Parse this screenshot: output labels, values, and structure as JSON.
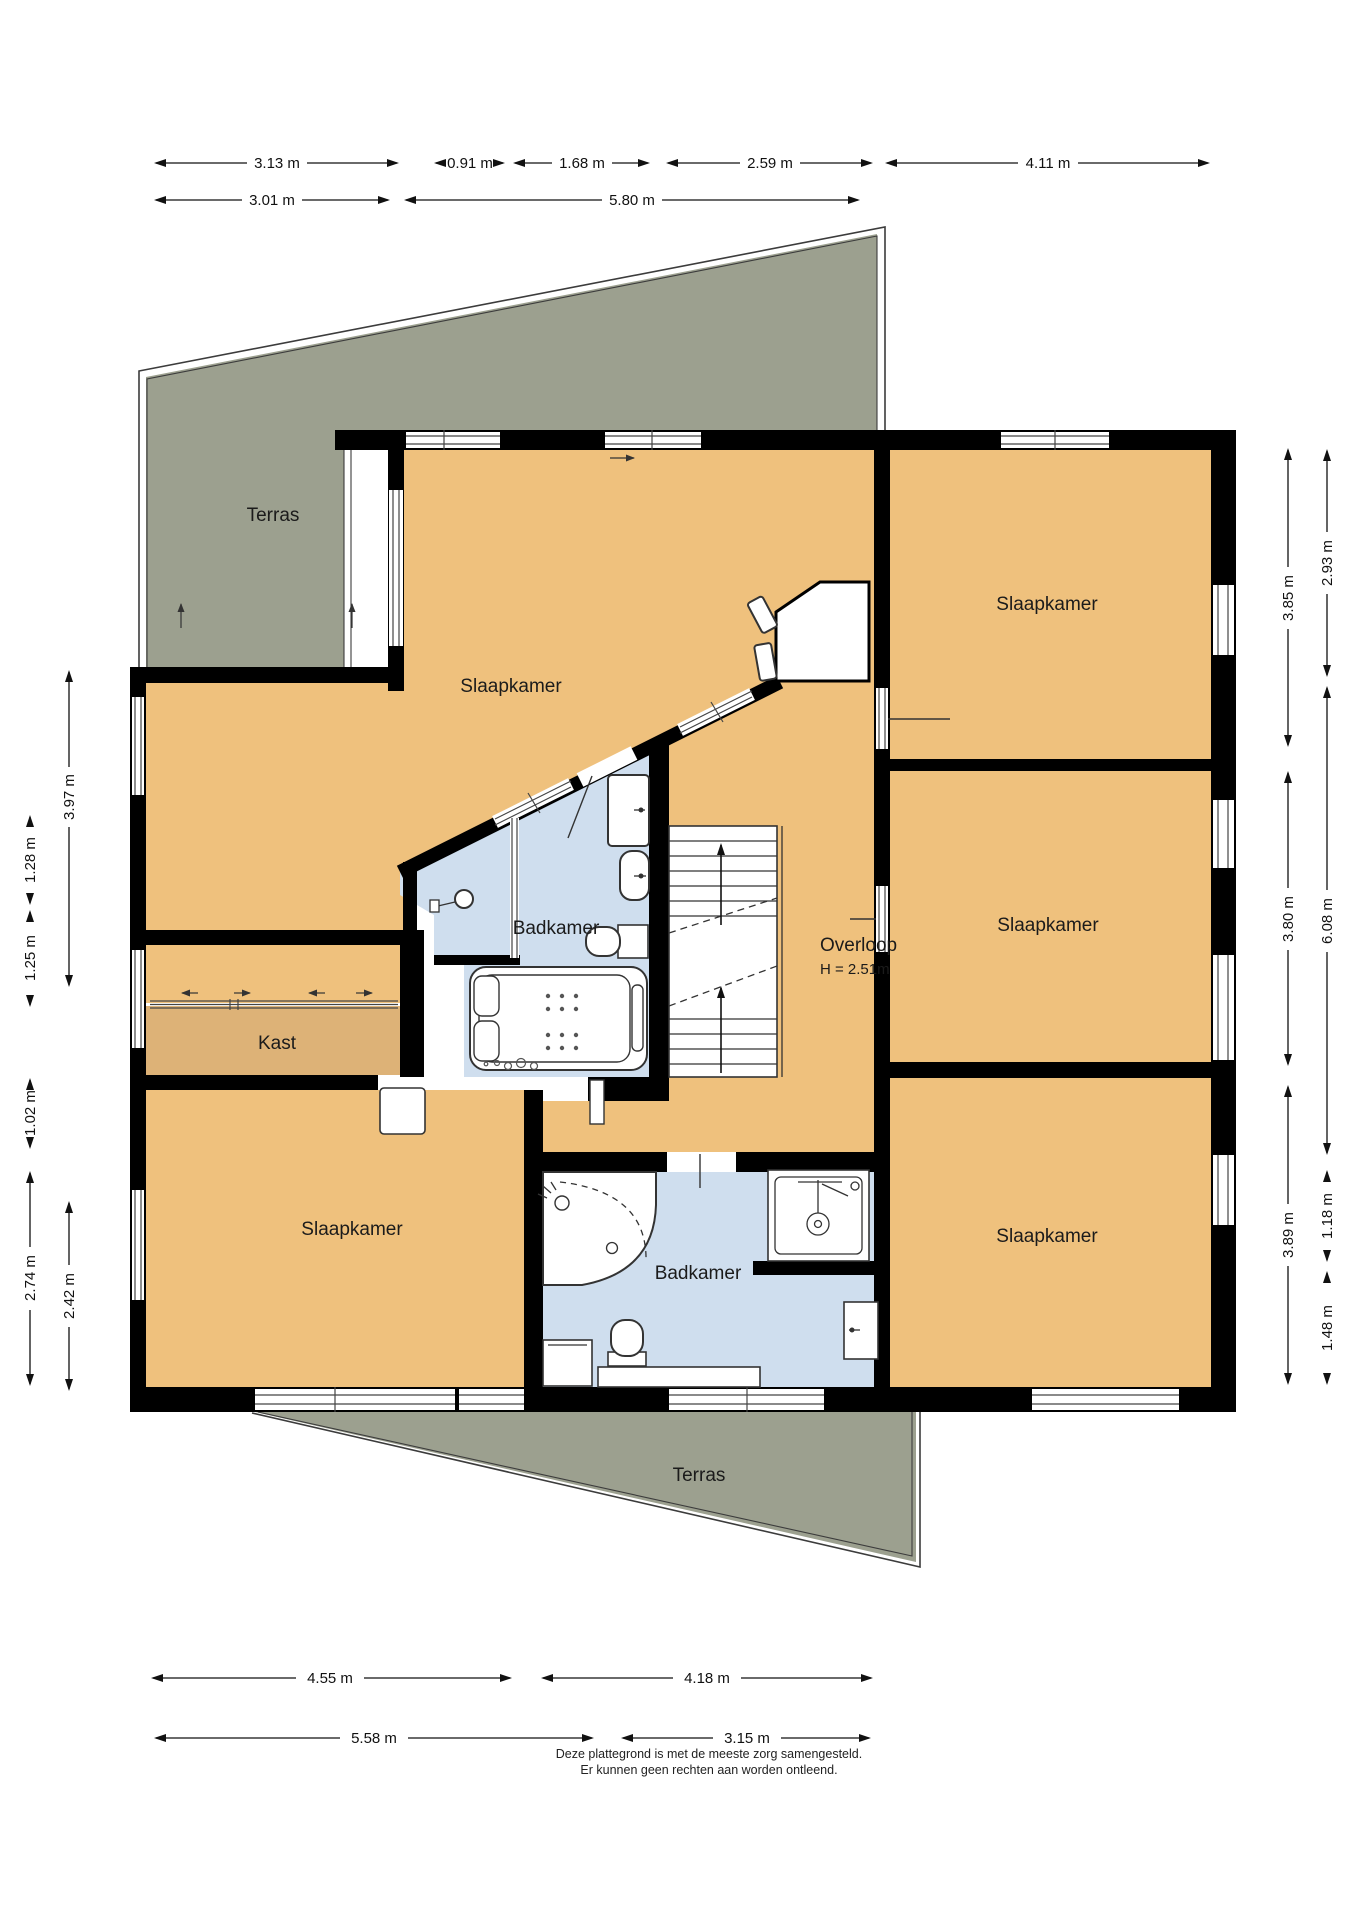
{
  "labels": {
    "terras_top": "Terras",
    "terras_bottom": "Terras",
    "bedroom_topleft": "Slaapkamer",
    "bedroom_topright": "Slaapkamer",
    "bedroom_midright": "Slaapkamer",
    "bedroom_bottomleft": "Slaapkamer",
    "bedroom_bottomright": "Slaapkamer",
    "bathroom_center": "Badkamer",
    "bathroom_bottom": "Badkamer",
    "closet": "Kast",
    "landing": "Overloop",
    "landing_height": "H = 2.51m"
  },
  "dims": {
    "top": [
      "3.13 m",
      "0.91 m",
      "1.68 m",
      "2.59 m",
      "4.11 m",
      "3.01 m",
      "5.80 m"
    ],
    "left": [
      "3.97 m",
      "1.28 m",
      "1.25 m",
      "1.02 m",
      "2.74 m",
      "2.42 m"
    ],
    "right": [
      "2.93 m",
      "3.85 m",
      "6.08 m",
      "3.80 m",
      "1.18 m",
      "3.89 m",
      "1.48 m"
    ],
    "bottom": [
      "4.55 m",
      "4.18 m",
      "5.58 m",
      "3.15 m"
    ]
  },
  "footer": {
    "line1": "Deze plattegrond is met de meeste zorg samengesteld.",
    "line2": "Er kunnen geen rechten aan worden ontleend."
  },
  "colors": {
    "room_floor": "#efc17d",
    "closet_floor": "#ddb277",
    "bathroom_floor": "#cfdeee",
    "terrace": "#9ca08f",
    "wall": "#000000"
  }
}
